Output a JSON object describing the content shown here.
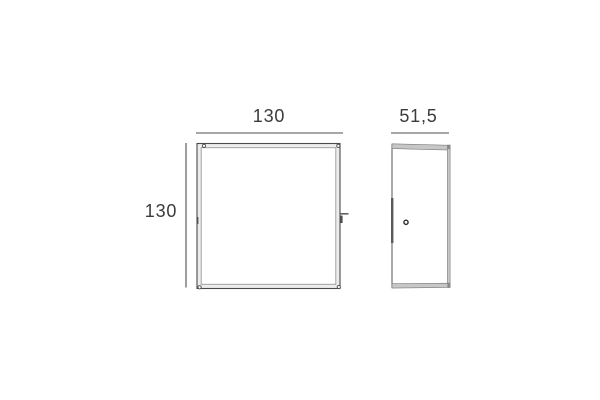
{
  "drawing": {
    "front_view": {
      "width_label": "130",
      "height_label": "130"
    },
    "side_view": {
      "depth_label": "51,5"
    }
  },
  "colors": {
    "background": "#ffffff",
    "outline_dark": "#4a4a4a",
    "outline_light": "#999999",
    "dimension_line": "#4f4f4f",
    "label_text": "#3b3b3b",
    "metal_gray": "#c7c7c7",
    "frame_fill": "#ededed"
  }
}
